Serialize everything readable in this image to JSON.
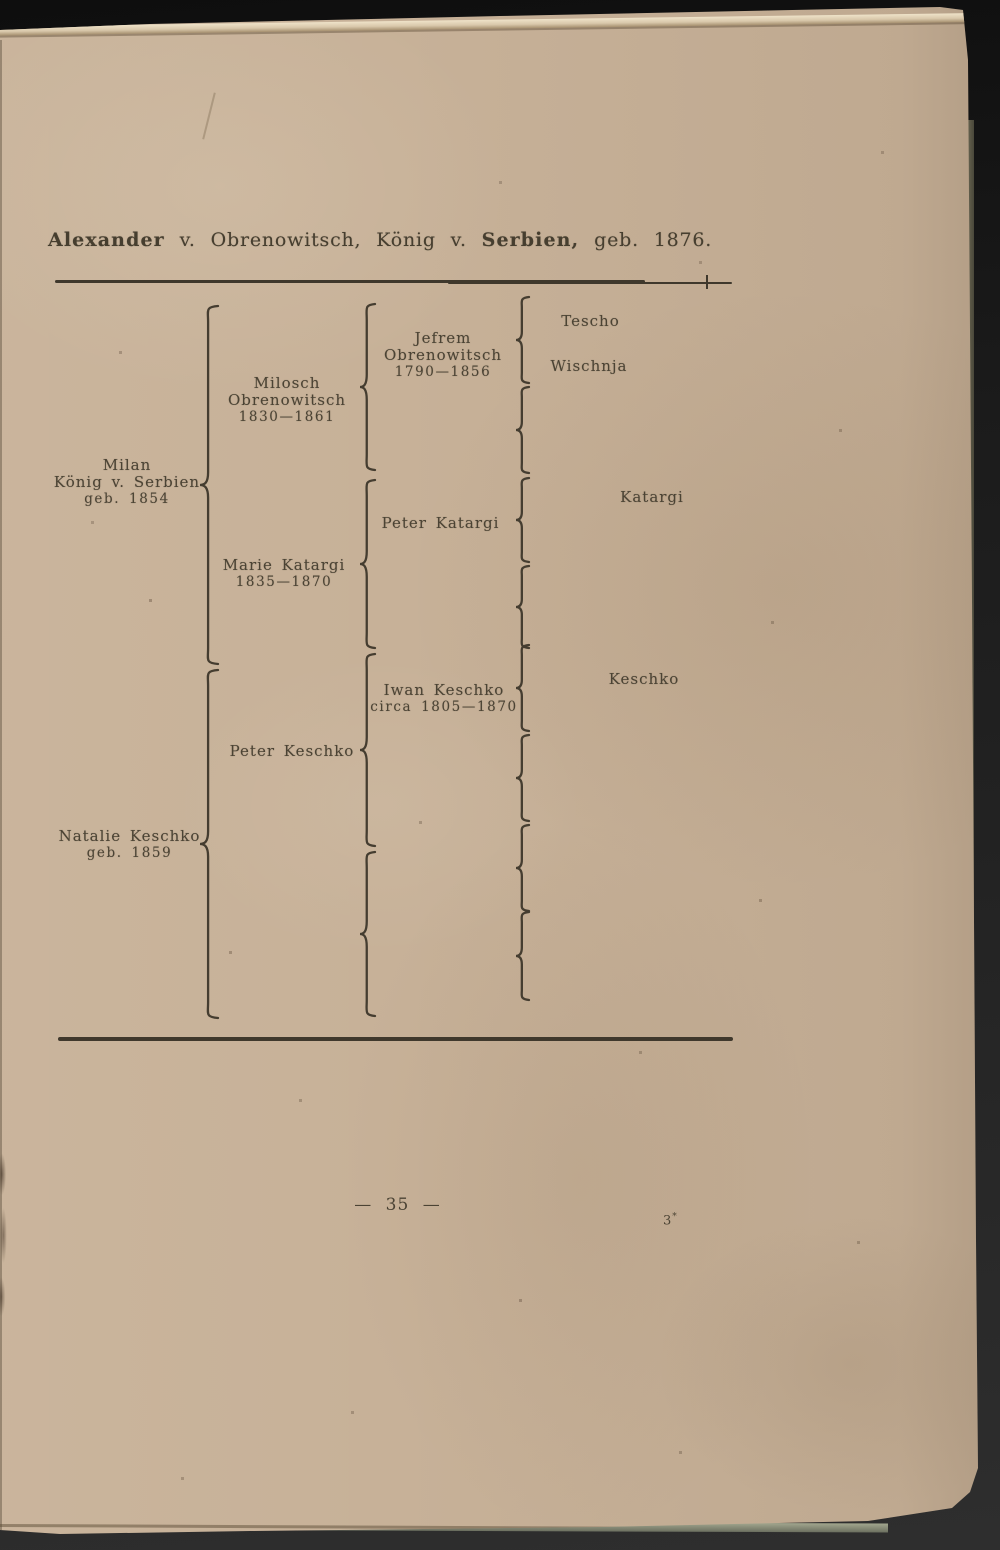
{
  "title": {
    "name": "Alexander",
    "mid": "v. Obrenowitsch, König v.",
    "country": "Serbien,",
    "suffix": "geb. 1876."
  },
  "chart": {
    "type": "genealogy-bracket-chart",
    "persons": {
      "milan": {
        "line1": "Milan",
        "line2": "König v. Serbien",
        "line3": "geb. 1854"
      },
      "natalie": {
        "line1": "Natalie Keschko",
        "line2": "geb. 1859"
      },
      "milosch": {
        "line1": "Milosch Obrenowitsch",
        "line2": "1830—1861"
      },
      "marie": {
        "line1": "Marie Katargi",
        "line2": "1835—1870"
      },
      "peter_keschko": {
        "line1": "Peter Keschko"
      },
      "jefrem": {
        "line1": "Jefrem Obrenowitsch",
        "line2": "1790—1856"
      },
      "peter_katargi": {
        "line1": "Peter Katargi"
      },
      "iwan": {
        "line1": "Iwan Keschko",
        "line2": "circa 1805—1870"
      },
      "tescho": {
        "line1": "Tescho"
      },
      "wischnja": {
        "line1": "Wischnja"
      },
      "katargi": {
        "line1": "Katargi"
      },
      "keschko": {
        "line1": "Keschko"
      }
    }
  },
  "footer": {
    "page_number": "— 35 —",
    "signature_base": "3",
    "signature_star": "*"
  },
  "colors": {
    "paper": "#c7b198",
    "ink": "#4b4334",
    "background": "#1e1e1e"
  }
}
